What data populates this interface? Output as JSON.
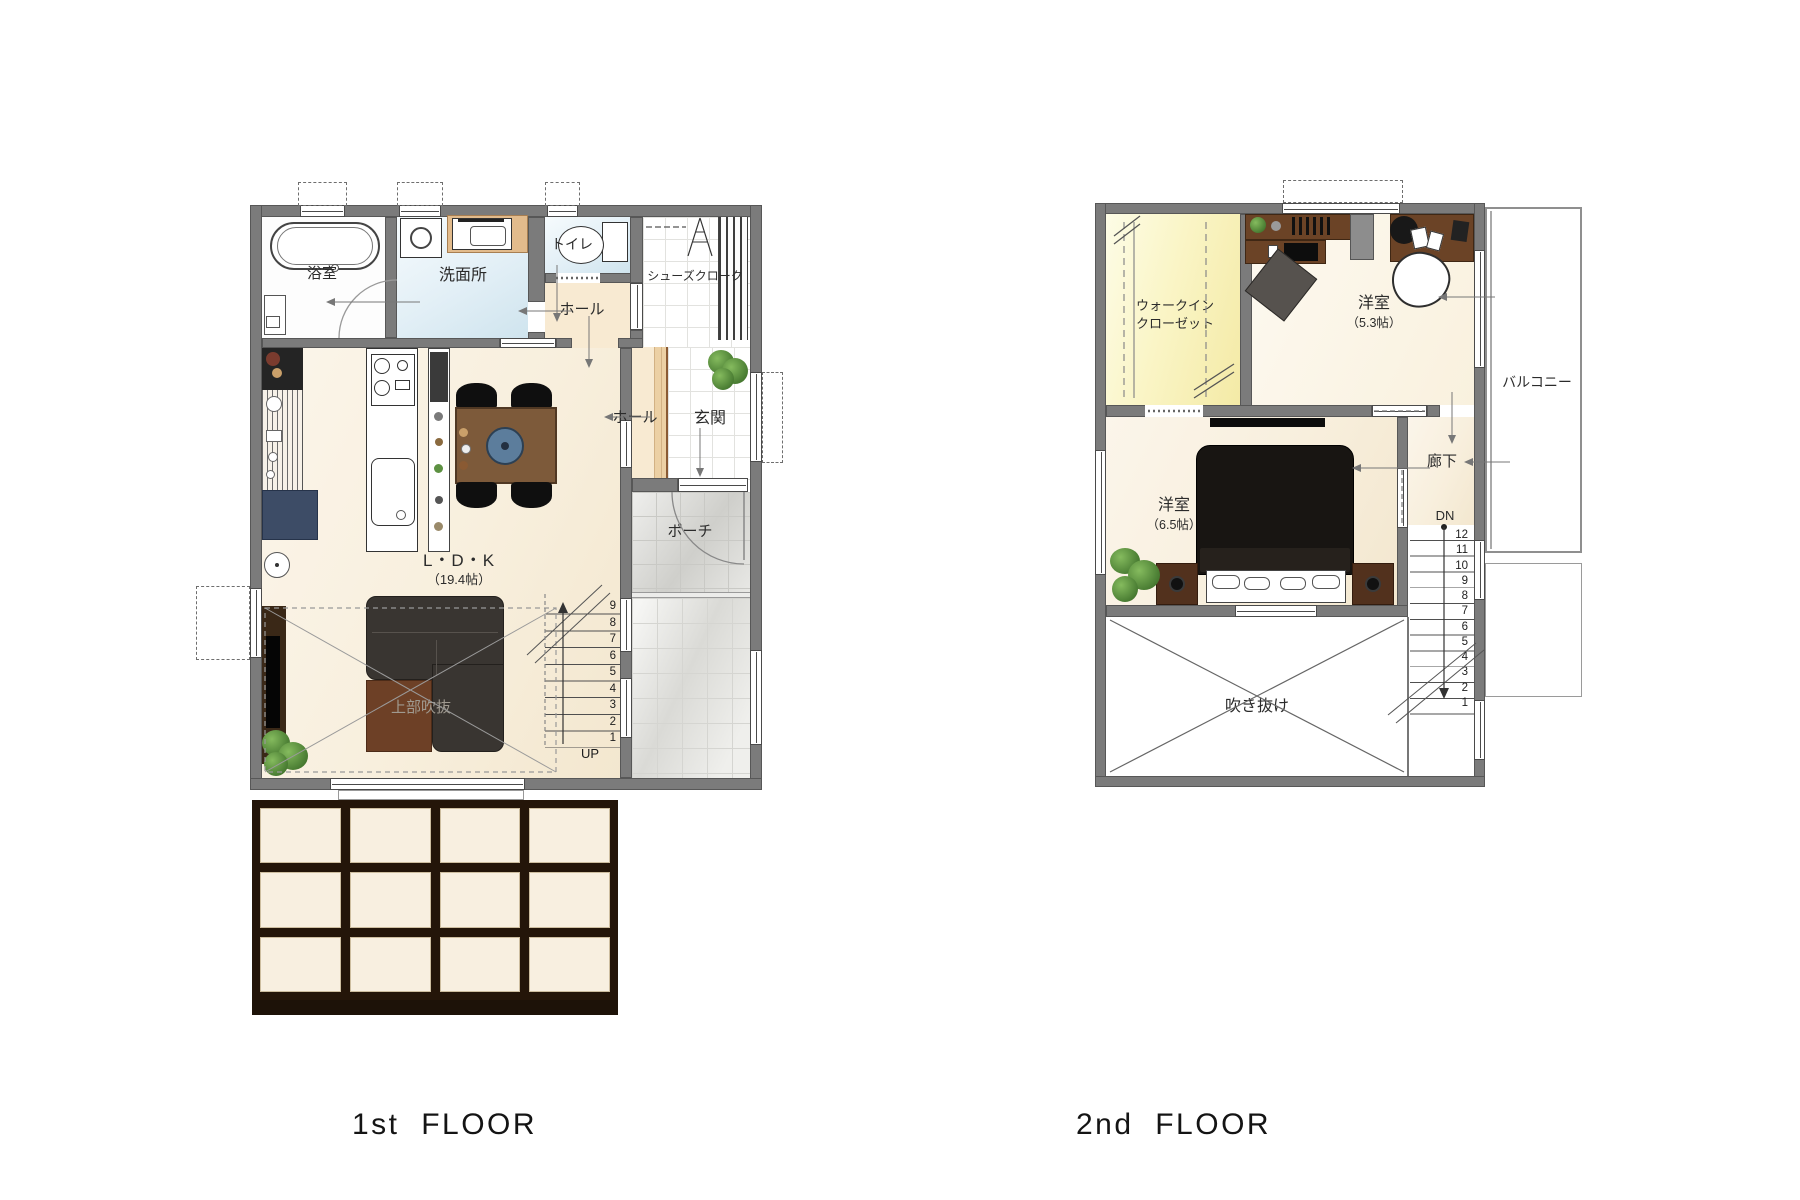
{
  "titles": {
    "floor1": "1st  FLOOR",
    "floor2": "2nd  FLOOR"
  },
  "floor1": {
    "rooms": {
      "bath": "浴室",
      "washroom": "洗面所",
      "toilet": "トイレ",
      "hall_upper": "ホール",
      "shoes_cloak": "シューズクローク",
      "hall_lower": "ホール",
      "entrance": "玄関",
      "porch": "ポーチ",
      "ldk_name": "L・D・K",
      "ldk_size": "（19.4帖）",
      "void_above": "上部吹抜",
      "stairs_up": "UP"
    },
    "stairs": [
      "9",
      "8",
      "7",
      "6",
      "5",
      "4",
      "3",
      "2",
      "1"
    ]
  },
  "floor2": {
    "rooms": {
      "wic_line1": "ウォークイン",
      "wic_line2": "クローゼット",
      "bedroom53_name": "洋室",
      "bedroom53_size": "（5.3帖）",
      "bedroom65_name": "洋室",
      "bedroom65_size": "（6.5帖）",
      "balcony": "バルコニー",
      "corridor": "廊下",
      "stairs_down": "DN",
      "void": "吹き抜け"
    },
    "stairs": [
      "12",
      "11",
      "10",
      "9",
      "8",
      "7",
      "6",
      "5",
      "4",
      "3",
      "2",
      "1"
    ]
  },
  "colors": {
    "wall": "#7b7b7b",
    "floor_cream": "#f8efdd",
    "water_blue": "#e2eff6",
    "wood_beige": "#ecd0a4",
    "wic_yellow": "#faf5c6",
    "porch_grey": "#cfcfcb",
    "deck_brown": "#241509",
    "furniture_brown": "#6b4326",
    "table_brown": "#7d5a3a",
    "sofa_dark": "#393531",
    "bed_black": "#181512",
    "fridge_navy": "#3d4c66",
    "accent_blue": "#5c7d9c",
    "plant_green": "#5d9142"
  }
}
